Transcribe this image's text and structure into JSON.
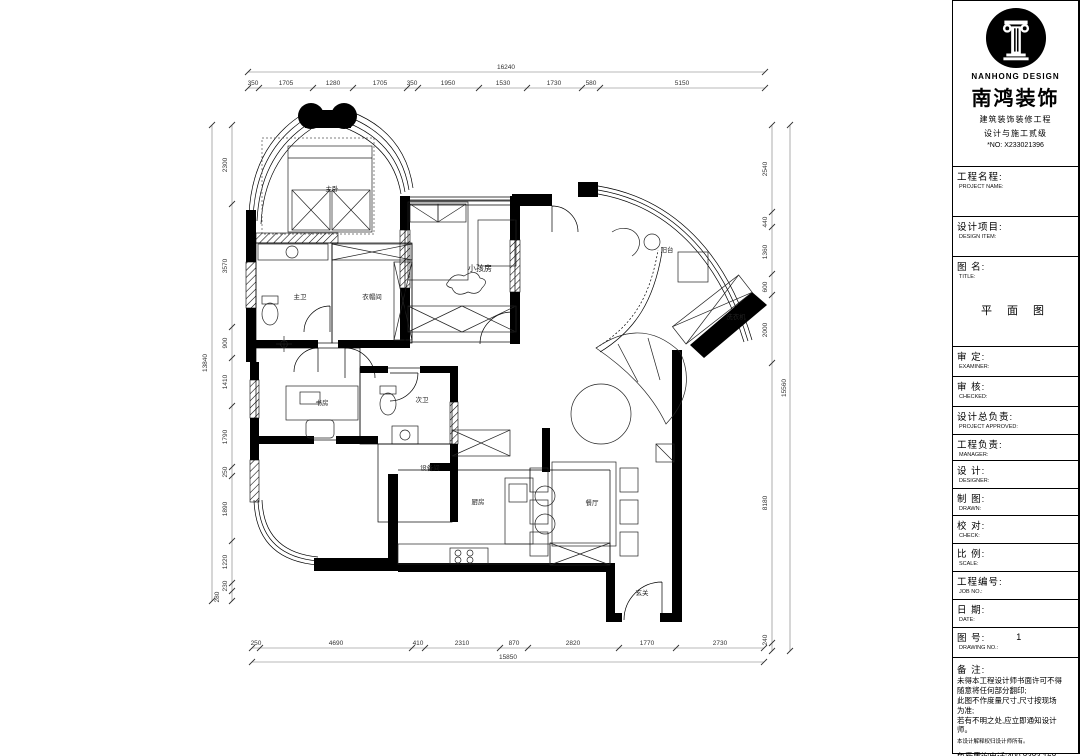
{
  "title_block": {
    "brand": {
      "logo_icon": "roman-column-icon",
      "name_en": "NANHONG DESIGN",
      "name_cn": "南鸿装饰",
      "cert_line1": "建筑装饰装修工程",
      "cert_line2": "设计与施工贰级",
      "cert_no": "*NO: X233021396"
    },
    "fields": [
      {
        "cn": "工程名程:",
        "en": "PROJECT NAME:",
        "value": ""
      },
      {
        "cn": "设计项目:",
        "en": "DESIGN ITEM:",
        "value": ""
      },
      {
        "cn": "图 名:",
        "en": "TITLE:",
        "value": "平 面 图"
      },
      {
        "cn": "审  定:",
        "en": "EXAMINER:",
        "value": ""
      },
      {
        "cn": "审  核:",
        "en": "CHECKED:",
        "value": ""
      },
      {
        "cn": "设计总负责:",
        "en": "PROJECT APPROVED:",
        "value": ""
      },
      {
        "cn": "工程负责:",
        "en": "MANAGER:",
        "value": ""
      },
      {
        "cn": "设  计:",
        "en": "DESIGNER:",
        "value": ""
      },
      {
        "cn": "制  图:",
        "en": "DRAWN:",
        "value": ""
      },
      {
        "cn": "校  对:",
        "en": "CHECK:",
        "value": ""
      },
      {
        "cn": "比  例:",
        "en": "SCALE:",
        "value": ""
      },
      {
        "cn": "工程编号:",
        "en": "JOB NO.:",
        "value": ""
      },
      {
        "cn": "日  期:",
        "en": "DATE:",
        "value": ""
      },
      {
        "cn": "图  号:",
        "en": "DRAWING NO.:",
        "value": "1"
      }
    ],
    "remarks": {
      "label_cn": "备  注:",
      "lines": [
        "未得本工程设计师书面许可不得",
        "随意将任何部分翻印;",
        "此图不作度量尺寸,尺寸按现场",
        "为准;",
        "若有不明之处,应立即通知设计",
        "师。"
      ],
      "small_line": "本设计解释权归设计师所有。",
      "hotline": "免费质询电话:400 8383 168"
    }
  },
  "plan": {
    "drawing_title": "平面图",
    "rooms": [
      "主卧",
      "主卫",
      "衣帽间",
      "小孩房",
      "书房",
      "次卫",
      "设备间",
      "厨房",
      "餐厅",
      "玄关",
      "阳台",
      "洗衣机"
    ],
    "dims": {
      "top": {
        "total": "16240",
        "segments": [
          "350",
          "1705",
          "1280",
          "1705",
          "350",
          "1950",
          "1530",
          "1730",
          "580",
          "5150"
        ]
      },
      "left": {
        "total": "13840",
        "segments": [
          "2300",
          "3570",
          "900",
          "1410",
          "1790",
          "250",
          "1890",
          "1220",
          "230",
          "280"
        ]
      },
      "right": {
        "total": "15560",
        "segments": [
          "2540",
          "440",
          "1360",
          "600",
          "2000",
          "8180",
          "240"
        ]
      },
      "bottom": {
        "total": "15850",
        "segments": [
          "250",
          "4690",
          "410",
          "2310",
          "870",
          "2820",
          "1770",
          "2730"
        ]
      }
    },
    "colors": {
      "wall": "#000000",
      "line": "#333333",
      "paper": "#ffffff"
    }
  }
}
